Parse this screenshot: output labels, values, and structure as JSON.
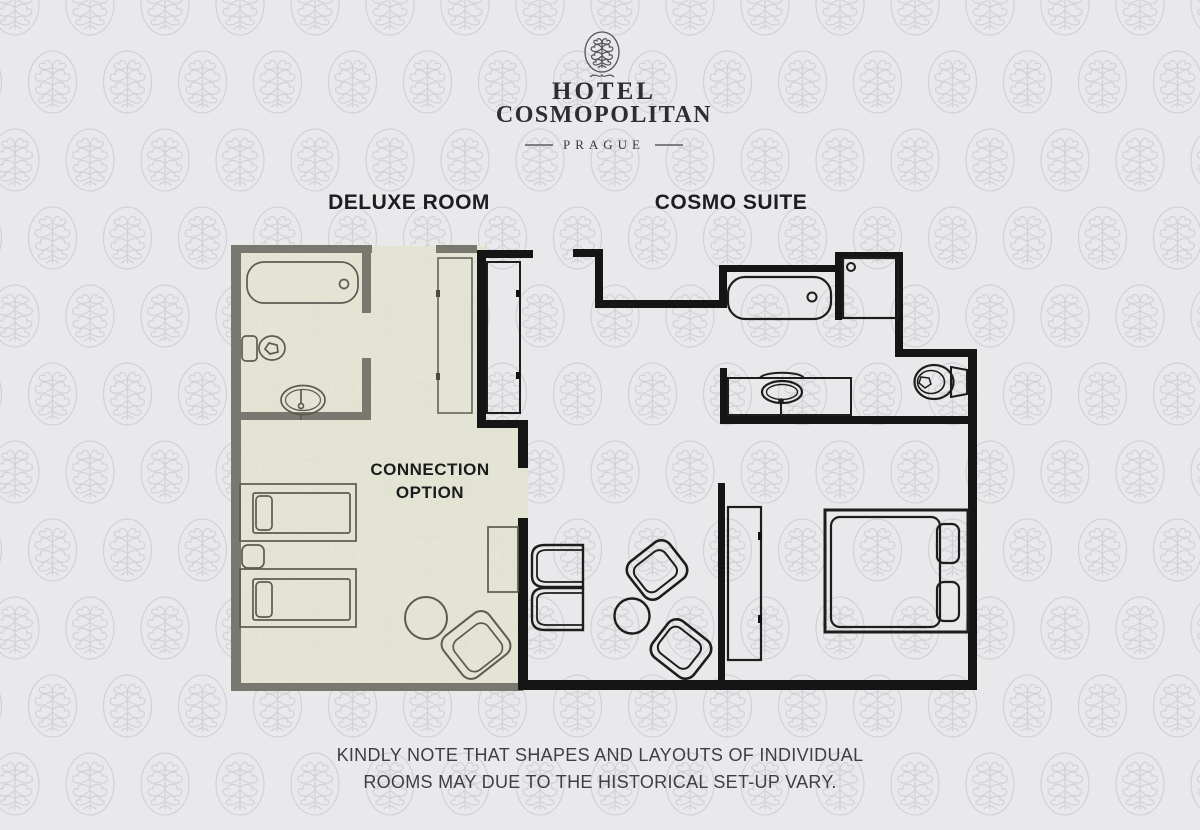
{
  "logo": {
    "line1": "HOTEL",
    "line2": "COSMOPOLITAN",
    "city": "PRAGUE"
  },
  "labels": {
    "deluxe_room": "DELUXE ROOM",
    "cosmo_suite": "COSMO SUITE",
    "connection_line1": "CONNECTION",
    "connection_line2": "OPTION"
  },
  "note": {
    "line1": "KINDLY NOTE THAT SHAPES AND LAYOUTS OF INDIVIDUAL",
    "line2": "ROOMS MAY DUE TO THE HISTORICAL SET-UP VARY."
  },
  "colors": {
    "background": "#e9e9eb",
    "pattern": "#d2d2d6",
    "deluxe_fill": "#e3e4d0",
    "deluxe_wall": "#78786f",
    "suite_wall": "#151515",
    "deluxe_fixture": "#5c5b52",
    "suite_fixture": "#1d1d1d",
    "crest": "#55555a",
    "label_text": "#1e1e21",
    "note_text": "#3f3f42"
  },
  "furniture": {
    "deluxe_room": [
      "bathtub",
      "toilet",
      "pedestal sink",
      "wardrobe",
      "twin bed",
      "nightstand",
      "twin bed",
      "round table",
      "armchair",
      "desk"
    ],
    "cosmo_suite": [
      "bathtub",
      "shower",
      "vanity sink",
      "toilet",
      "closet",
      "sofa",
      "armchair",
      "armchair",
      "coffee table",
      "wardrobe",
      "double bed"
    ]
  }
}
